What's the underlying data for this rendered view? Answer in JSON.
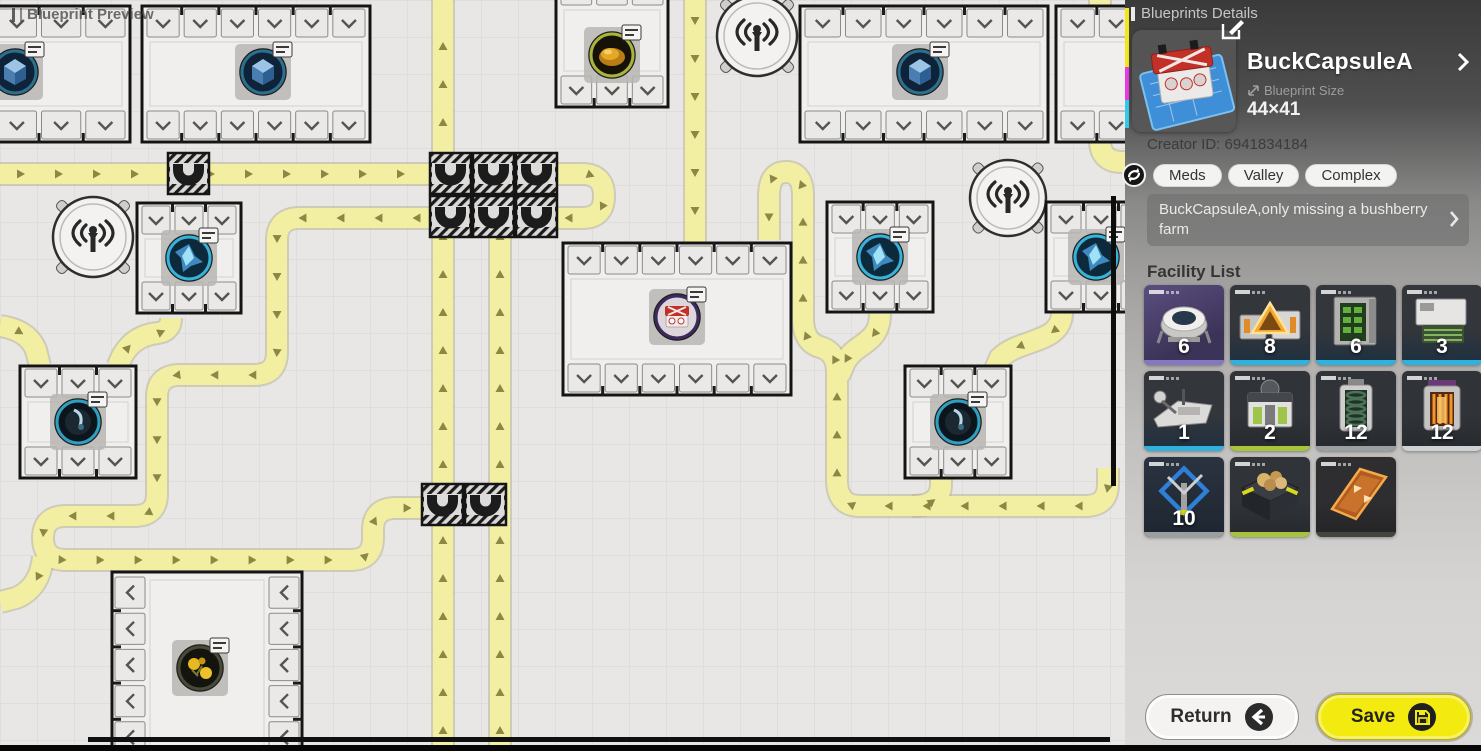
{
  "preview": {
    "title": "Blueprint Preview",
    "bg": "#e8e7e5",
    "grid_line": "rgba(95,92,84,0.13)",
    "cell": 37,
    "belt": {
      "fill": "#f2efa2",
      "edge": "#b8b493",
      "arrow": "#8d8745"
    },
    "conveyors": [
      "M 0 174 H 582 Q 604 174 604 196 Q 604 218 582 218 H 300 Q 277 218 277 240 L 277 352 Q 277 375 254 375 H 180 Q 157 375 157 397 L 157 494 Q 157 516 134 516 H 66 Q 43 516 43 538 Q 43 560 66 560 H 350 Q 373 560 373 538 L 373 530 Q 373 508 396 508 H 440",
      "M 443 751 L 443 0",
      "M 500 751 L 500 205",
      "M 695 0 L 695 245",
      "M 1108 468 L 1108 484 Q 1108 506 1085 506 H 860 Q 837 506 837 480 L 837 372 Q 837 352 820 347 Q 803 342 803 318 L 803 196 Q 803 172 786 172 Q 769 172 769 196 L 769 240",
      "M 912 506 Q 941 506 941 484 L 941 472",
      "M 880 314 C 880 344 856 342 845 362 L 839 376",
      "M 1062 312 C 1062 344 1020 338 1000 358 L 994 372",
      "M 1100 0 L 1100 140 Q 1100 162 1122 162 H 1130",
      "M 0 326 Q 28 330 36 350 L 40 366",
      "M 118 366 Q 128 336 158 333 Q 171 331 171 318",
      "M 43 557 Q 40 588 16 598 L 0 602"
    ],
    "ublock_size": 41,
    "ublocks": [
      [
        168,
        153
      ],
      [
        430,
        153
      ],
      [
        473,
        153
      ],
      [
        516,
        153
      ],
      [
        430,
        196
      ],
      [
        473,
        196
      ],
      [
        516,
        196
      ],
      [
        422,
        484
      ],
      [
        465,
        484
      ]
    ],
    "towers": [
      [
        93,
        237,
        40
      ],
      [
        757,
        36,
        40
      ],
      [
        1008,
        198,
        38
      ]
    ],
    "buildings": [
      {
        "x": -52,
        "y": 6,
        "w": 182,
        "h": 136,
        "orient": "h",
        "ports": 4,
        "machine": [
          "cube",
          15,
          72
        ]
      },
      {
        "x": 142,
        "y": 6,
        "w": 228,
        "h": 136,
        "orient": "h",
        "ports": 6,
        "machine": [
          "cube",
          263,
          72
        ]
      },
      {
        "x": 556,
        "y": -26,
        "w": 112,
        "h": 133,
        "orient": "h",
        "ports": 3,
        "machine": [
          "amber",
          612,
          55
        ]
      },
      {
        "x": 800,
        "y": 6,
        "w": 248,
        "h": 136,
        "orient": "h",
        "ports": 6,
        "machine": [
          "cube",
          920,
          72
        ]
      },
      {
        "x": 1056,
        "y": 6,
        "w": 120,
        "h": 136,
        "orient": "h",
        "ports": 3,
        "machine": null
      },
      {
        "x": 137,
        "y": 203,
        "w": 104,
        "h": 110,
        "orient": "h",
        "ports": 3,
        "machine": [
          "crystal",
          189,
          258
        ]
      },
      {
        "x": 827,
        "y": 202,
        "w": 106,
        "h": 110,
        "orient": "h",
        "ports": 3,
        "machine": [
          "crystal",
          880,
          257
        ]
      },
      {
        "x": 1046,
        "y": 202,
        "w": 110,
        "h": 110,
        "orient": "h",
        "ports": 3,
        "machine": [
          "crystal",
          1096,
          257
        ]
      },
      {
        "x": 563,
        "y": 243,
        "w": 228,
        "h": 152,
        "orient": "h",
        "ports": 6,
        "machine": [
          "capsule",
          677,
          317
        ]
      },
      {
        "x": 20,
        "y": 366,
        "w": 116,
        "h": 112,
        "orient": "h",
        "ports": 3,
        "machine": [
          "sphere",
          78,
          422
        ]
      },
      {
        "x": 905,
        "y": 366,
        "w": 106,
        "h": 112,
        "orient": "h",
        "ports": 3,
        "machine": [
          "sphere",
          958,
          422
        ]
      },
      {
        "x": 112,
        "y": 572,
        "w": 190,
        "h": 186,
        "orient": "v",
        "ports": 5,
        "machine": [
          "flower",
          200,
          668
        ]
      }
    ],
    "scroll_v": [
      1111,
      196,
      5,
      290
    ],
    "scroll_h": [
      88,
      737,
      1022,
      5
    ]
  },
  "panel": {
    "header": "Blueprints Details",
    "title": "BuckCapsuleA",
    "size_label": "Blueprint Size",
    "size_value": "44×41",
    "creator": "Creator ID: 6941834184",
    "tags": [
      "Meds",
      "Valley",
      "Complex"
    ],
    "description": "BuckCapsuleA,only missing a bushberry farm",
    "facility_title": "Facility List",
    "return_label": "Return",
    "save_label": "Save",
    "edge_segments": [
      {
        "color": "#f2e718",
        "y": 8,
        "h": 59
      },
      {
        "color": "#e83ae0",
        "y": 67,
        "h": 33
      },
      {
        "color": "#35c8e8",
        "y": 100,
        "h": 28
      }
    ],
    "colors": {
      "accent_yellow": "#f3ea10",
      "tag_bg": "#f3f3f2",
      "count_text": "#ffffff"
    },
    "facilities": [
      {
        "count": "6",
        "icon": "planter",
        "bar": "#8578c2",
        "bg": "linear-gradient(155deg,#5b4e80,#3c3458 70%)"
      },
      {
        "count": "8",
        "icon": "refiner",
        "bar": "#2fb3de",
        "bg": "linear-gradient(180deg,#33363b 55%,#1e3040)"
      },
      {
        "count": "6",
        "icon": "rack",
        "bar": "#2fb3de",
        "bg": "linear-gradient(180deg,#33363b 55%,#1e3040)"
      },
      {
        "count": "3",
        "icon": "tray",
        "bar": "#2fb3de",
        "bg": "linear-gradient(180deg,#33363b 55%,#1e3040)"
      },
      {
        "count": "1",
        "icon": "thresher",
        "bar": "#2fb3de",
        "bg": "linear-gradient(180deg,#33363b 55%,#1e3040)"
      },
      {
        "count": "2",
        "icon": "press",
        "bar": "#a6c43c",
        "bg": "linear-gradient(180deg,#303338 55%,#26292e)"
      },
      {
        "count": "12",
        "icon": "silo",
        "bar": "#9aa0a2",
        "bg": "linear-gradient(180deg,#303338 55%,#26292e)"
      },
      {
        "count": "12",
        "icon": "furnace",
        "bar": "#cfd2d3",
        "bg": "linear-gradient(180deg,#303338 55%,#26292e)"
      },
      {
        "count": "10",
        "icon": "frame",
        "bar": "#9aa0a2",
        "bg": "linear-gradient(180deg,#2a3340,#1d2630)"
      },
      {
        "count": "",
        "icon": "farmbox",
        "bar": "#a6c43c",
        "bg": "linear-gradient(180deg,#303338 55%,#26292e)"
      },
      {
        "count": "",
        "icon": "ramp",
        "bar": "#43463c",
        "bg": "linear-gradient(180deg,#2e2e30 55%,#242426)"
      }
    ]
  }
}
